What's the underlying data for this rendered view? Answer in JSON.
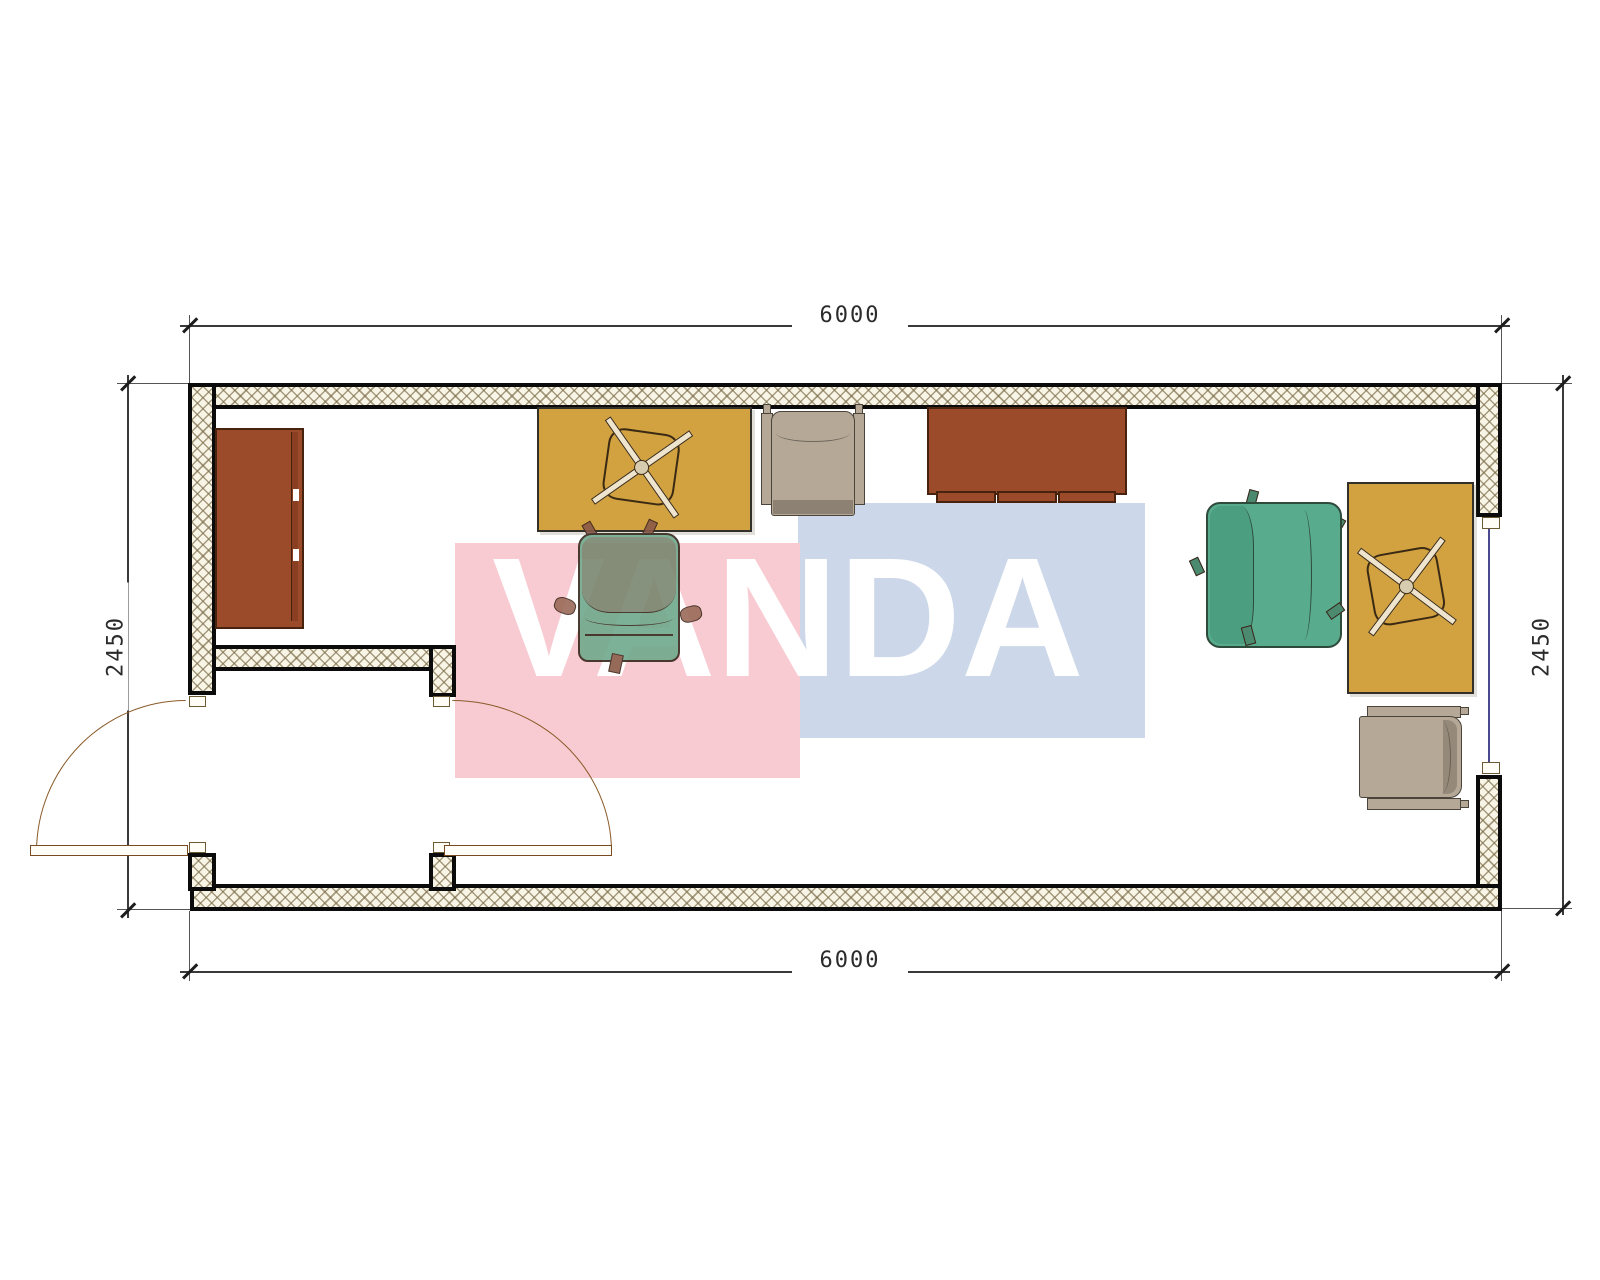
{
  "watermark": {
    "text": "VANDA",
    "pink_color": "#f8cbd2",
    "blue_color": "#ccd8e9",
    "text_color": "#ffffff"
  },
  "dimensions": {
    "top": "6000",
    "bottom": "6000",
    "left": "2450",
    "right": "2450"
  },
  "plan": {
    "type": "container-office-floor-plan",
    "width_label": "6000",
    "depth_label": "2450",
    "furniture": [
      {
        "name": "tall-cabinet",
        "color": "#9c4b2a"
      },
      {
        "name": "desk-1",
        "color": "#d2a140"
      },
      {
        "name": "swivel-chair-symbol-1",
        "color": "#efe5cf"
      },
      {
        "name": "task-chair-1",
        "color": "#6fa98c"
      },
      {
        "name": "visitor-armchair-1",
        "color": "#b5a897"
      },
      {
        "name": "sideboard",
        "color": "#9c4b2a"
      },
      {
        "name": "task-chair-2",
        "color": "#58ab8d"
      },
      {
        "name": "desk-2",
        "color": "#d2a140"
      },
      {
        "name": "swivel-chair-symbol-2",
        "color": "#efe5cf"
      },
      {
        "name": "visitor-armchair-2",
        "color": "#b5a897"
      }
    ],
    "openings": [
      {
        "name": "exterior-entry-door",
        "swing": "out"
      },
      {
        "name": "vestibule-interior-door",
        "swing": "in"
      },
      {
        "name": "side-window",
        "glass_color": "#4a4a8f"
      }
    ],
    "wall_hatch_bg": "#f8f4e6"
  }
}
